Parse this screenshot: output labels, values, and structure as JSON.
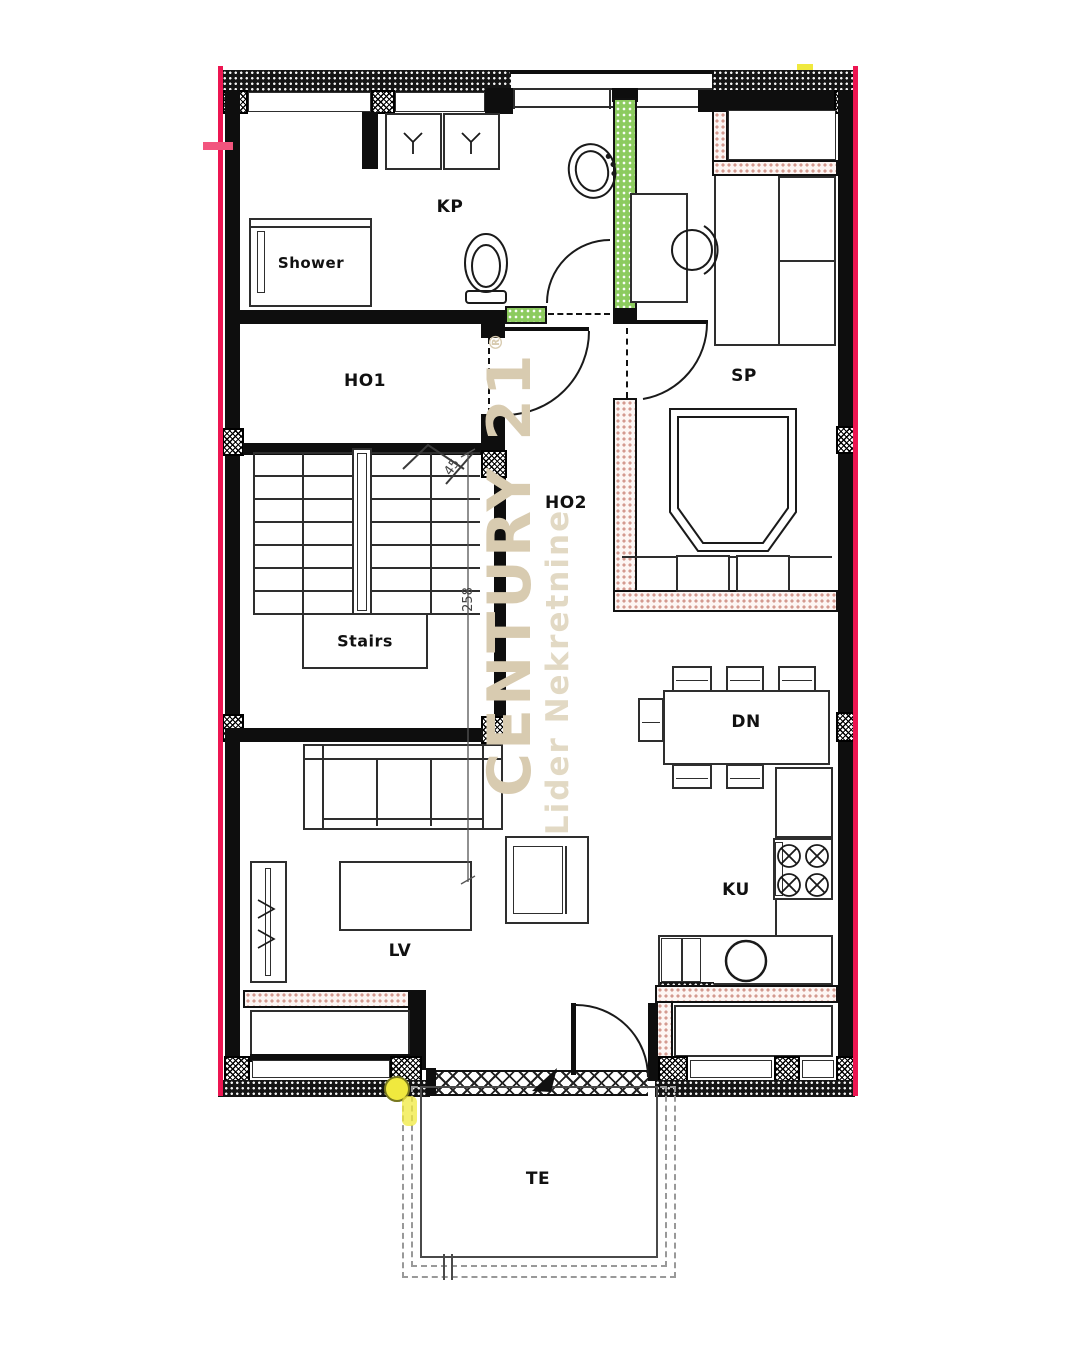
{
  "plan": {
    "rooms": {
      "kp": "KP",
      "shower": "Shower",
      "ho1": "HO1",
      "sp": "SP",
      "ho2": "HO2",
      "stairs": "Stairs",
      "dn": "DN",
      "lv": "LV",
      "ku": "KU",
      "te": "TE"
    },
    "dimensions": {
      "stair_width": "45",
      "stair_run": "258"
    },
    "watermark": {
      "brand": "CENTURY 21",
      "registered": "®",
      "subtitle": "Lider Nekretnine"
    },
    "colors": {
      "boundary_red": "#ed1551",
      "glass_green": "#8ccb5e",
      "insulation_pink": "#d49a90",
      "watermark_beige": "#d8cbb0",
      "marker_yellow": "#f0e93e"
    }
  }
}
